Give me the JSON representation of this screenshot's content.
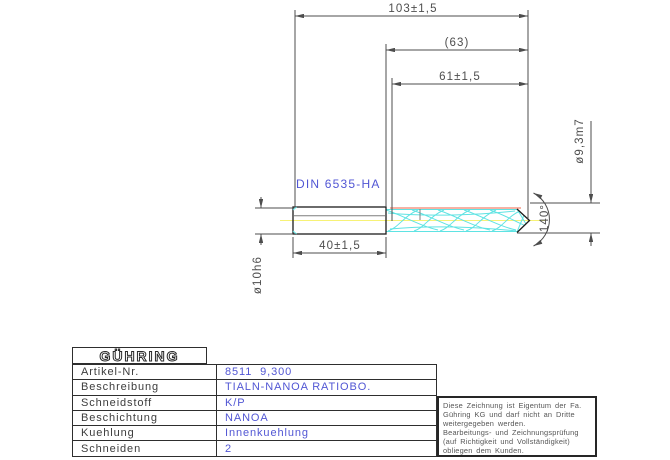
{
  "colors": {
    "blue": "#5156d4",
    "cyan": "#5fe3e3",
    "yellow": "#f7f276",
    "red": "#f2836e",
    "line": "#4d4d4d",
    "outline": "#1c1c1c",
    "label": "#3c3c3c",
    "note": "#565656",
    "logo": "#2a2a2a"
  },
  "drawing": {
    "dims": {
      "overall_length": "103±1,5",
      "flute_length_ref": "(63)",
      "flute_length": "61±1,5",
      "shank_length": "40±1,5",
      "shank_diameter": "ø10h6",
      "drill_diameter": "ø9,3m7",
      "point_angle": "140°",
      "shank_standard": "DIN 6535-HA"
    }
  },
  "title_block": {
    "logo": "GÜHRING",
    "rows": [
      {
        "label": "Artikel-Nr.",
        "value": "8511  9,300"
      },
      {
        "label": "Beschreibung",
        "value": "TIALN-NANOA RATIOBO."
      },
      {
        "label": "Schneidstoff",
        "value": "K/P"
      },
      {
        "label": "Beschichtung",
        "value": "NANOA"
      },
      {
        "label": "Kuehlung",
        "value": "Innenkuehlung"
      },
      {
        "label": "Schneiden",
        "value": "2"
      }
    ]
  },
  "disclaimer": {
    "lines": [
      "Diese Zeichnung ist Eigentum der Fa.",
      "Gühring KG und darf nicht an Dritte",
      "weitergegeben werden.",
      "Bearbeitungs- und Zeichnungsprüfung",
      "(auf Richtigkeit und Vollständigkeit)",
      "obliegen dem Kunden."
    ]
  }
}
